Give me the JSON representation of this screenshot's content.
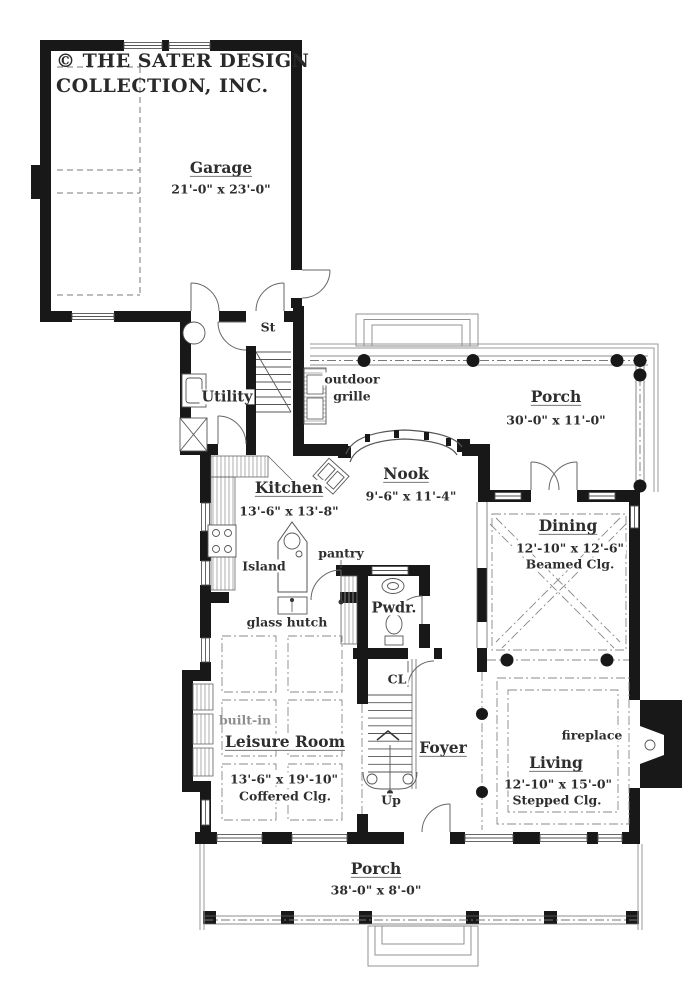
{
  "brand": {
    "line1": "© THE SATER DESIGN",
    "line2": "COLLECTION, INC."
  },
  "rooms": {
    "garage": {
      "name": "Garage",
      "dims": "21'-0\" x 23'-0\""
    },
    "porch_upper": {
      "name": "Porch",
      "dims": "30'-0\" x 11'-0\""
    },
    "utility": {
      "name": "Utility"
    },
    "kitchen": {
      "name": "Kitchen",
      "dims": "13'-6\" x 13'-8\""
    },
    "nook": {
      "name": "Nook",
      "dims": "9'-6\" x 11'-4\""
    },
    "dining": {
      "name": "Dining",
      "dims": "12'-10\" x 12'-6\"",
      "ceiling": "Beamed Clg."
    },
    "powder": {
      "name": "Pwdr."
    },
    "leisure": {
      "name": "Leisure Room",
      "dims": "13'-6\" x 19'-10\"",
      "ceiling": "Coffered Clg."
    },
    "foyer": {
      "name": "Foyer"
    },
    "living": {
      "name": "Living",
      "dims": "12'-10\" x 15'-0\"",
      "ceiling": "Stepped Clg."
    },
    "porch_lower": {
      "name": "Porch",
      "dims": "38'-0\" x 8'-0\""
    }
  },
  "annotations": {
    "stairs_abbr": "St",
    "outdoor_grille_line1": "outdoor",
    "outdoor_grille_line2": "grille",
    "island": "Island",
    "pantry": "pantry",
    "glass_hutch": "glass hutch",
    "closet_abbr": "CL",
    "built_in": "built-in",
    "up_label": "Up",
    "fireplace": "fireplace"
  },
  "colors": {
    "wall": "#181818",
    "line": "#555555",
    "dash_line": "#888888",
    "text": "#2e2e2e",
    "muted_text": "#8d8d8d",
    "background": "#ffffff"
  }
}
